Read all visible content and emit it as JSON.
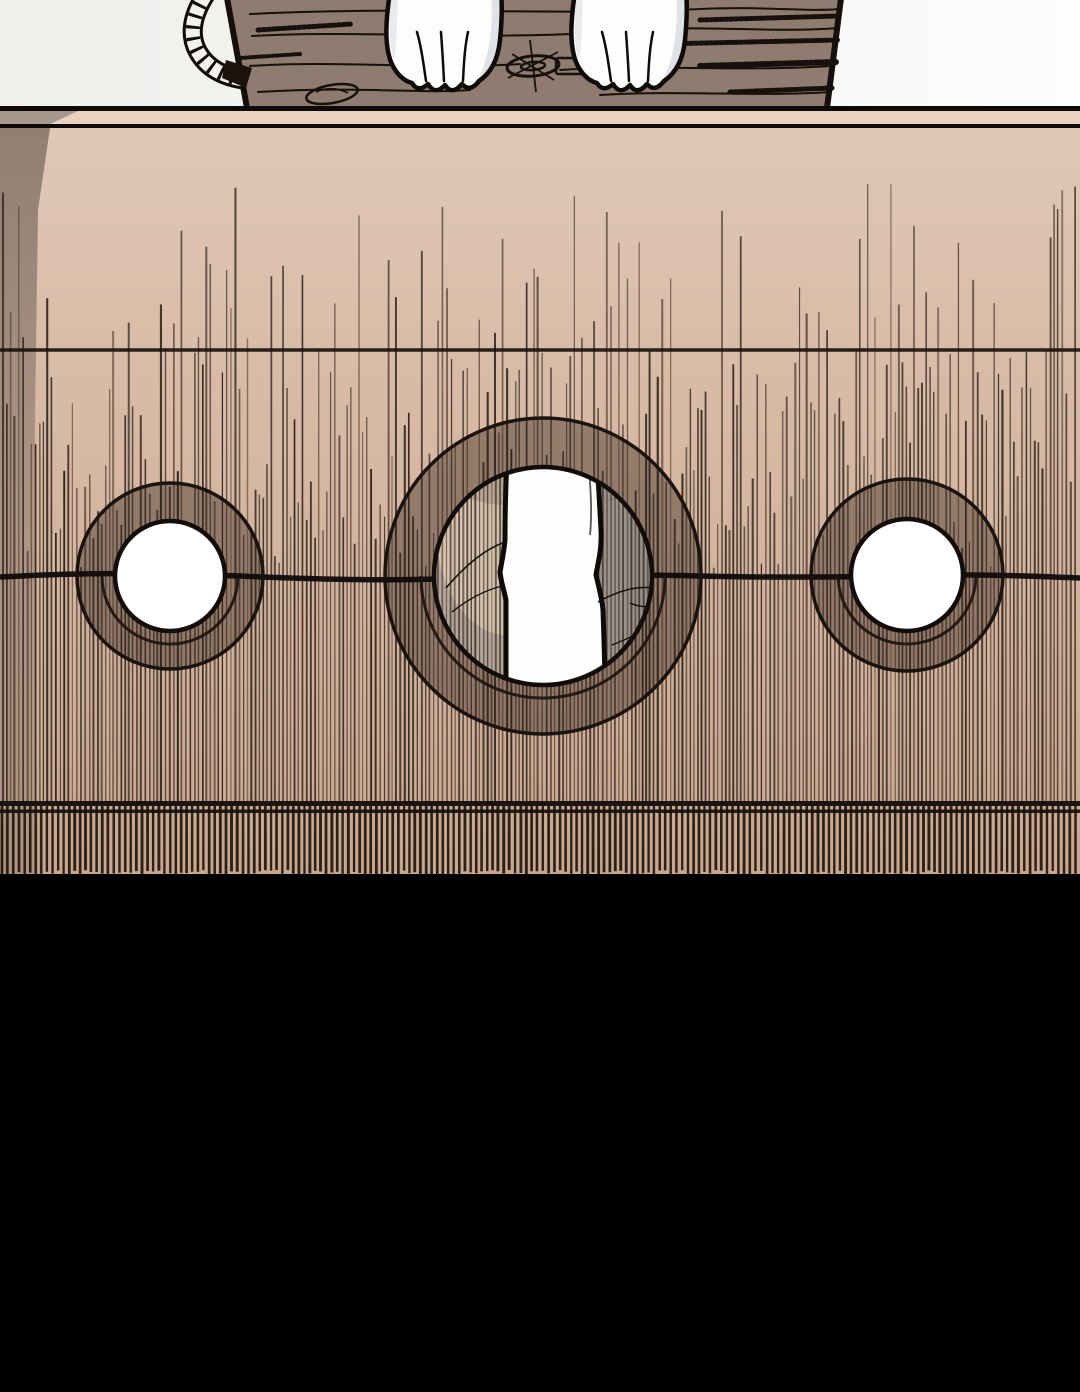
{
  "scene": {
    "type": "comic-panel",
    "elements": [
      "wooden-log",
      "left-paw",
      "right-paw",
      "rope-loop",
      "pillory-board",
      "left-hole",
      "center-hole",
      "right-hole",
      "limb-through-center-hole",
      "black-floor"
    ]
  },
  "colors": {
    "sky_left": "#f0efec",
    "sky_right": "#fdfdfc",
    "log_fill": "#8d7c6f",
    "log_line": "#17100b",
    "paw_fill": "#fdfdfc",
    "paw_shade": "#dfe2e6",
    "paw_outline": "#0e0b08",
    "rope_fill": "#f3f1ee",
    "ink": "#0f0b08",
    "strip_tan": "#e9d2bf",
    "strip_gray": "#a5968e",
    "board_top": "#e0c8b7",
    "board_mid": "#d8bba6",
    "board_low": "#cfae97",
    "board_bottom": "#c9a78f",
    "gray_edge": "#7a6a5f",
    "hatch_dark": "#2c211a",
    "hatch_brown": "#5a4638",
    "comb": "#1f160f",
    "ring_overlay": "rgba(82,64,52,0.50)",
    "hole_white": "#ffffff",
    "interior_base": "#b3a69b",
    "interior_light": "#d8c6af",
    "interior_dark": "#968b83",
    "limb_fill": "#fdfdfc",
    "floor": "#000000"
  },
  "board": {
    "top_line_y": 106,
    "strip_top_y": 111,
    "strip_bottom_y": 124,
    "face_top_y": 128,
    "upper_grain_line_y": 350,
    "split_line_y": 576,
    "lower_line_y1": 803,
    "lower_line_y2": 811,
    "board_bottom_y": 876,
    "holes": [
      {
        "id": "left",
        "cx": 170,
        "cy": 576,
        "r_inner": 55,
        "r_outer": 93
      },
      {
        "id": "center",
        "cx": 543,
        "cy": 576,
        "r_inner": 109,
        "r_outer": 158
      },
      {
        "id": "right",
        "cx": 907,
        "cy": 575,
        "r_inner": 56,
        "r_outer": 96
      }
    ]
  },
  "hatch": {
    "seed": 7,
    "spacing_min": 3.4,
    "spacing_max": 4.6,
    "tall_ratio": 0.28,
    "tall_tip_min": 182,
    "tall_tip_max": 352,
    "short_tip_min": 352,
    "short_tip_max": 568,
    "end_y": 803,
    "comb_spacing": 5.3,
    "comb_top": 806,
    "comb_bottom": 876,
    "interior_spacing": 3.8
  }
}
